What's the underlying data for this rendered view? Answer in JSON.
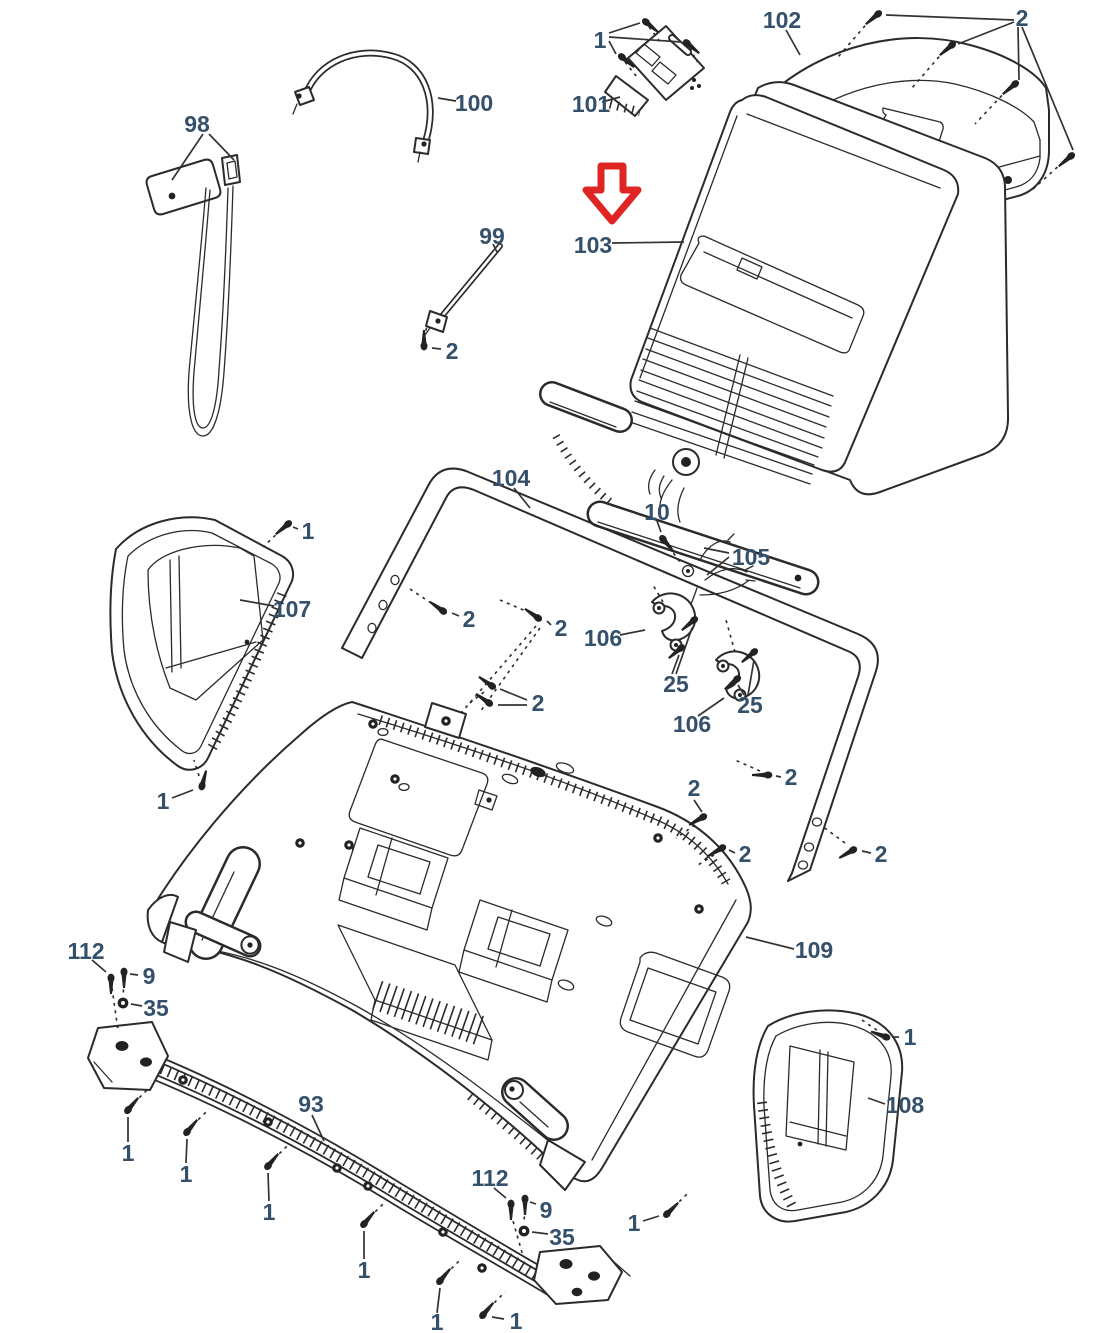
{
  "diagram": {
    "type": "exploded-parts-diagram",
    "subject": "treadmill console assembly parts drawing",
    "background_color": "#ffffff",
    "line_color": "#2b2b2b",
    "label_color": "#35506b",
    "highlight_arrow": {
      "shape": "red-outline-down-arrow",
      "color": "#e02423",
      "points_to_part": "103"
    },
    "callouts": [
      {
        "text": "1"
      },
      {
        "text": "101"
      },
      {
        "text": "102"
      },
      {
        "text": "2"
      },
      {
        "text": "100"
      },
      {
        "text": "98"
      },
      {
        "text": "99"
      },
      {
        "text": "2"
      },
      {
        "text": "103"
      },
      {
        "text": "104"
      },
      {
        "text": "10"
      },
      {
        "text": "105"
      },
      {
        "text": "2"
      },
      {
        "text": "2"
      },
      {
        "text": "106"
      },
      {
        "text": "25"
      },
      {
        "text": "2"
      },
      {
        "text": "106"
      },
      {
        "text": "25"
      },
      {
        "text": "107"
      },
      {
        "text": "1"
      },
      {
        "text": "1"
      },
      {
        "text": "2"
      },
      {
        "text": "2"
      },
      {
        "text": "2"
      },
      {
        "text": "2"
      },
      {
        "text": "109"
      },
      {
        "text": "1"
      },
      {
        "text": "108"
      },
      {
        "text": "112"
      },
      {
        "text": "9"
      },
      {
        "text": "35"
      },
      {
        "text": "93"
      },
      {
        "text": "1"
      },
      {
        "text": "1"
      },
      {
        "text": "1"
      },
      {
        "text": "1"
      },
      {
        "text": "1"
      },
      {
        "text": "1"
      },
      {
        "text": "112"
      },
      {
        "text": "9"
      },
      {
        "text": "35"
      },
      {
        "text": "1"
      }
    ]
  }
}
